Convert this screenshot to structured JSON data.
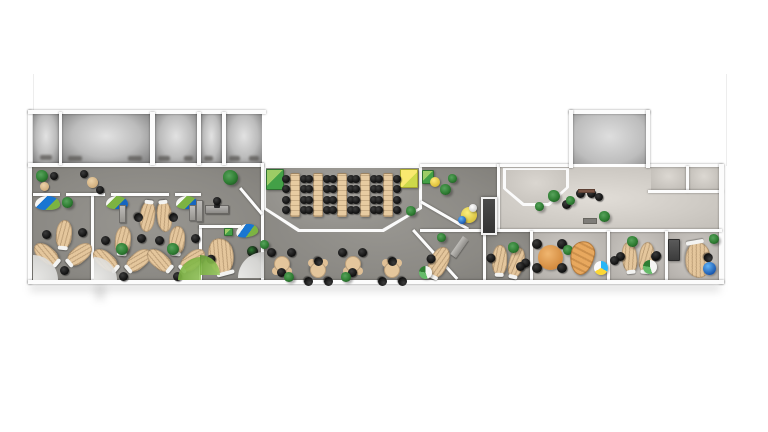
{
  "scene": {
    "name": "office-floor-plan",
    "style": "3d-top-down-architectural-render",
    "canvas": {
      "width": 768,
      "height": 432
    }
  },
  "palette": {
    "background": "#ffffff",
    "wall": "#fcfcfc",
    "floor_gray": "#8f8d89",
    "floor_beige": "#dcd8d2",
    "desk_wood": "#e4c69c",
    "chair_black": "#141414",
    "accent_green": "#7cb342",
    "accent_blue": "#1976d2",
    "accent_yellow": "#f4d94d",
    "plant_green": "#2e7d32",
    "elevator_dark": "#3d3d3d",
    "table_orange": "#e09a52"
  },
  "rooms": [
    {
      "name": "left-wing-floor",
      "x": 32,
      "y": 167,
      "w": 229,
      "h": 113,
      "floor": "gray"
    },
    {
      "name": "center-zone-floor",
      "x": 264,
      "y": 167,
      "w": 236,
      "h": 113,
      "floor": "gray"
    },
    {
      "name": "lobby-floor",
      "x": 500,
      "y": 167,
      "w": 219,
      "h": 63,
      "floor": "beige"
    },
    {
      "name": "office-right-1",
      "x": 486,
      "y": 232,
      "w": 44,
      "h": 48,
      "floor": "gray"
    },
    {
      "name": "office-right-2",
      "x": 533,
      "y": 232,
      "w": 74,
      "h": 48,
      "floor": "beige-gray"
    },
    {
      "name": "office-right-3",
      "x": 610,
      "y": 232,
      "w": 55,
      "h": 48,
      "floor": "beige-gray"
    },
    {
      "name": "office-right-4",
      "x": 668,
      "y": 232,
      "w": 51,
      "h": 48,
      "floor": "beige-gray"
    },
    {
      "name": "top-room-1",
      "x": 33,
      "y": 114,
      "w": 26,
      "h": 49,
      "floor": "cell"
    },
    {
      "name": "top-room-2",
      "x": 62,
      "y": 114,
      "w": 88,
      "h": 49,
      "floor": "cell"
    },
    {
      "name": "top-room-3",
      "x": 155,
      "y": 114,
      "w": 42,
      "h": 49,
      "floor": "cell"
    },
    {
      "name": "top-room-4",
      "x": 201,
      "y": 114,
      "w": 21,
      "h": 49,
      "floor": "cell"
    },
    {
      "name": "top-room-5",
      "x": 226,
      "y": 114,
      "w": 36,
      "h": 49,
      "floor": "cell"
    },
    {
      "name": "top-room-right",
      "x": 573,
      "y": 114,
      "w": 73,
      "h": 50,
      "floor": "cell-bright"
    },
    {
      "name": "top-small-room-1",
      "x": 651,
      "y": 167,
      "w": 35,
      "h": 23,
      "floor": "beige-light"
    },
    {
      "name": "top-small-room-2",
      "x": 689,
      "y": 167,
      "w": 30,
      "h": 23,
      "floor": "beige-light"
    },
    {
      "name": "training-room-walls",
      "x": 263,
      "y": 166,
      "w": 159,
      "h": 66,
      "floor": "wallfloor",
      "shape": "octagon"
    },
    {
      "name": "training-room-floor",
      "x": 266,
      "y": 168,
      "w": 153,
      "h": 61,
      "floor": "gray-light",
      "shape": "octagon"
    },
    {
      "name": "lobby-pod-walls",
      "x": 503,
      "y": 168,
      "w": 66,
      "h": 38,
      "floor": "wallfloor",
      "shape": "pod"
    },
    {
      "name": "lobby-pod-floor",
      "x": 506,
      "y": 170,
      "w": 60,
      "h": 33,
      "floor": "pod",
      "shape": "pod"
    }
  ],
  "walls": [
    {
      "x": 28,
      "y": 110,
      "w": 4,
      "h": 174
    },
    {
      "x": 28,
      "y": 110,
      "w": 238,
      "h": 4
    },
    {
      "x": 28,
      "y": 163,
      "w": 236,
      "h": 4
    },
    {
      "x": 59,
      "y": 112,
      "w": 3,
      "h": 53
    },
    {
      "x": 150,
      "y": 112,
      "w": 5,
      "h": 53
    },
    {
      "x": 197,
      "y": 112,
      "w": 4,
      "h": 53
    },
    {
      "x": 222,
      "y": 112,
      "w": 4,
      "h": 53
    },
    {
      "x": 261,
      "y": 163,
      "w": 3,
      "h": 119
    },
    {
      "x": 91,
      "y": 193,
      "w": 3,
      "h": 89
    },
    {
      "x": 33,
      "y": 193,
      "w": 27,
      "h": 3
    },
    {
      "x": 66,
      "y": 193,
      "w": 39,
      "h": 3
    },
    {
      "x": 111,
      "y": 193,
      "w": 58,
      "h": 3
    },
    {
      "x": 175,
      "y": 193,
      "w": 26,
      "h": 3
    },
    {
      "x": 199,
      "y": 225,
      "w": 3,
      "h": 57
    },
    {
      "x": 199,
      "y": 225,
      "w": 42,
      "h": 3
    },
    {
      "x": 239,
      "y": 189,
      "w": 3,
      "h": 34,
      "r": -40
    },
    {
      "x": 420,
      "y": 164,
      "w": 80,
      "h": 3
    },
    {
      "x": 420,
      "y": 203,
      "w": 3,
      "h": 55,
      "r": -60
    },
    {
      "x": 497,
      "y": 164,
      "w": 3,
      "h": 68
    },
    {
      "x": 500,
      "y": 164,
      "w": 72,
      "h": 3
    },
    {
      "x": 646,
      "y": 164,
      "w": 77,
      "h": 3
    },
    {
      "x": 569,
      "y": 110,
      "w": 81,
      "h": 4
    },
    {
      "x": 569,
      "y": 110,
      "w": 4,
      "h": 58
    },
    {
      "x": 646,
      "y": 110,
      "w": 4,
      "h": 58
    },
    {
      "x": 686,
      "y": 166,
      "w": 3,
      "h": 26
    },
    {
      "x": 648,
      "y": 190,
      "w": 75,
      "h": 3
    },
    {
      "x": 719,
      "y": 164,
      "w": 5,
      "h": 120
    },
    {
      "x": 420,
      "y": 229,
      "w": 302,
      "h": 3
    },
    {
      "x": 483,
      "y": 231,
      "w": 3,
      "h": 51
    },
    {
      "x": 530,
      "y": 231,
      "w": 3,
      "h": 51
    },
    {
      "x": 607,
      "y": 231,
      "w": 3,
      "h": 51
    },
    {
      "x": 665,
      "y": 231,
      "w": 3,
      "h": 51
    },
    {
      "x": 412,
      "y": 231,
      "w": 3,
      "h": 66,
      "r": -42
    },
    {
      "x": 28,
      "y": 280,
      "w": 696,
      "h": 4
    },
    {
      "x": 33,
      "y": 74,
      "w": 1,
      "h": 38,
      "v": "faint"
    },
    {
      "x": 726,
      "y": 74,
      "w": 1,
      "h": 92,
      "v": "faint"
    }
  ],
  "shadows": [
    {
      "x": 30,
      "y": 283,
      "w": 690,
      "h": 9
    },
    {
      "x": 95,
      "y": 284,
      "w": 10,
      "h": 16
    }
  ],
  "furniture": [
    {
      "t": "plant",
      "x": 36,
      "y": 170,
      "d": 12
    },
    {
      "t": "stool",
      "x": 40,
      "y": 182,
      "d": 9
    },
    {
      "t": "chair",
      "x": 50,
      "y": 172,
      "d": 8
    },
    {
      "t": "stool",
      "x": 87,
      "y": 177,
      "d": 11
    },
    {
      "t": "chair",
      "x": 80,
      "y": 170,
      "d": 8
    },
    {
      "t": "chair",
      "x": 96,
      "y": 186,
      "d": 8
    },
    {
      "t": "plant",
      "x": 223,
      "y": 170,
      "d": 15
    },
    {
      "t": "lounge",
      "x": 35,
      "y": 196,
      "w": 25,
      "h": 14,
      "v": "blue"
    },
    {
      "t": "plant",
      "x": 62,
      "y": 197,
      "d": 11
    },
    {
      "t": "trefoil",
      "x": 36,
      "y": 220
    },
    {
      "t": "rug",
      "x": 33,
      "y": 255,
      "d": 25,
      "v": "whiterug",
      "corner": "bl"
    },
    {
      "t": "lounge",
      "x": 106,
      "y": 196,
      "w": 22,
      "h": 13,
      "v": "green"
    },
    {
      "t": "lounge",
      "x": 176,
      "y": 196,
      "w": 22,
      "h": 13,
      "v": "green"
    },
    {
      "t": "sideboard",
      "x": 119,
      "y": 205,
      "w": 7,
      "h": 18
    },
    {
      "t": "sideboard",
      "x": 189,
      "y": 205,
      "w": 7,
      "h": 16
    },
    {
      "t": "deskpair",
      "x": 134,
      "y": 198,
      "r": 180
    },
    {
      "t": "trefoil",
      "x": 95,
      "y": 226
    },
    {
      "t": "trefoil",
      "x": 149,
      "y": 226
    },
    {
      "t": "plant",
      "x": 116,
      "y": 243,
      "d": 12
    },
    {
      "t": "plant",
      "x": 167,
      "y": 243,
      "d": 12
    },
    {
      "t": "rug",
      "x": 94,
      "y": 257,
      "d": 23,
      "v": "whiterug",
      "corner": "bl"
    },
    {
      "t": "rug",
      "x": 178,
      "y": 257,
      "d": 23,
      "v": "greenrug",
      "corner": "br"
    },
    {
      "t": "sideboard",
      "x": 196,
      "y": 200,
      "w": 7,
      "h": 22
    },
    {
      "t": "deskgray",
      "x": 205,
      "y": 205,
      "w": 24,
      "h": 9
    },
    {
      "t": "chair",
      "x": 213,
      "y": 197,
      "d": 8
    },
    {
      "t": "cabinet",
      "x": 224,
      "y": 228,
      "w": 9,
      "h": 8,
      "v": "green"
    },
    {
      "t": "lounge",
      "x": 236,
      "y": 224,
      "w": 22,
      "h": 13,
      "v": "blue",
      "r": -10
    },
    {
      "t": "deskC",
      "x": 206,
      "y": 236,
      "r": -15
    },
    {
      "t": "ball",
      "x": 247,
      "y": 246,
      "d": 11,
      "v": "darkgreen"
    },
    {
      "t": "rug",
      "x": 238,
      "y": 252,
      "d": 26,
      "v": "whiterug",
      "corner": "br"
    },
    {
      "t": "rug",
      "x": 200,
      "y": 255,
      "d": 20,
      "v": "greenrug",
      "corner": "bl"
    },
    {
      "t": "cabinet",
      "x": 266,
      "y": 169,
      "w": 18,
      "h": 21,
      "v": "green"
    },
    {
      "t": "cabinet",
      "x": 400,
      "y": 169,
      "w": 18,
      "h": 19,
      "v": "yellow"
    },
    {
      "t": "ttable",
      "x": 281,
      "y": 173
    },
    {
      "t": "ttable",
      "x": 304,
      "y": 173
    },
    {
      "t": "ttable",
      "x": 328,
      "y": 173
    },
    {
      "t": "ttable",
      "x": 351,
      "y": 173
    },
    {
      "t": "ttable",
      "x": 374,
      "y": 173
    },
    {
      "t": "plant",
      "x": 406,
      "y": 206,
      "d": 10
    },
    {
      "t": "cafe",
      "x": 267,
      "y": 248
    },
    {
      "t": "cafe",
      "x": 303,
      "y": 256,
      "r": 180
    },
    {
      "t": "cafe",
      "x": 338,
      "y": 248
    },
    {
      "t": "cafe",
      "x": 377,
      "y": 256,
      "r": 180
    },
    {
      "t": "plant",
      "x": 284,
      "y": 272,
      "d": 10
    },
    {
      "t": "plant",
      "x": 341,
      "y": 272,
      "d": 10
    },
    {
      "t": "plant",
      "x": 260,
      "y": 240,
      "d": 9
    },
    {
      "t": "cabinet",
      "x": 422,
      "y": 170,
      "w": 12,
      "h": 14,
      "v": "green"
    },
    {
      "t": "ball",
      "x": 430,
      "y": 177,
      "d": 10,
      "v": "yellow"
    },
    {
      "t": "plant",
      "x": 440,
      "y": 184,
      "d": 11
    },
    {
      "t": "plant",
      "x": 448,
      "y": 174,
      "d": 9
    },
    {
      "t": "rtable",
      "x": 461,
      "y": 207,
      "d": 16,
      "v": "yellowtable"
    },
    {
      "t": "ball",
      "x": 458,
      "y": 216,
      "d": 8,
      "v": "blue"
    },
    {
      "t": "ball",
      "x": 469,
      "y": 204,
      "d": 8,
      "v": "whiteball"
    },
    {
      "t": "elevator",
      "x": 481,
      "y": 197,
      "w": 16,
      "h": 38
    },
    {
      "t": "ramp",
      "x": 456,
      "y": 236,
      "w": 7,
      "h": 22,
      "r": 35
    },
    {
      "t": "desksingle",
      "x": 426,
      "y": 244,
      "r": 25
    },
    {
      "t": "ball",
      "x": 419,
      "y": 266,
      "d": 13,
      "v": "greenwhite"
    },
    {
      "t": "plant",
      "x": 437,
      "y": 233,
      "d": 9
    },
    {
      "t": "deskpair",
      "x": 486,
      "y": 244,
      "r": 8
    },
    {
      "t": "plant",
      "x": 508,
      "y": 242,
      "d": 11
    },
    {
      "t": "chair",
      "x": 516,
      "y": 262,
      "d": 9
    },
    {
      "t": "plant",
      "x": 548,
      "y": 190,
      "d": 12
    },
    {
      "t": "plant",
      "x": 535,
      "y": 202,
      "d": 9
    },
    {
      "t": "chair",
      "x": 576,
      "y": 189,
      "d": 9
    },
    {
      "t": "chair",
      "x": 587,
      "y": 189,
      "d": 9
    },
    {
      "t": "chair",
      "x": 562,
      "y": 200,
      "d": 9
    },
    {
      "t": "plant",
      "x": 566,
      "y": 196,
      "d": 9
    },
    {
      "t": "mat",
      "x": 583,
      "y": 218,
      "w": 14,
      "h": 6,
      "v": "graymat"
    },
    {
      "t": "mat",
      "x": 578,
      "y": 189,
      "w": 17,
      "h": 4,
      "v": "brownmat"
    },
    {
      "t": "plant",
      "x": 599,
      "y": 211,
      "d": 11
    },
    {
      "t": "chair",
      "x": 595,
      "y": 193,
      "d": 8
    },
    {
      "t": "rtable",
      "x": 538,
      "y": 245,
      "d": 25,
      "v": "orangetable"
    },
    {
      "t": "chair",
      "x": 532,
      "y": 239,
      "d": 10
    },
    {
      "t": "chair",
      "x": 557,
      "y": 239,
      "d": 10
    },
    {
      "t": "chair",
      "x": 532,
      "y": 263,
      "d": 10
    },
    {
      "t": "chair",
      "x": 557,
      "y": 263,
      "d": 10
    },
    {
      "t": "plant",
      "x": 563,
      "y": 245,
      "d": 10
    },
    {
      "t": "sofa",
      "x": 570,
      "y": 241,
      "w": 24,
      "h": 34,
      "r": 12
    },
    {
      "t": "ball",
      "x": 594,
      "y": 261,
      "d": 14,
      "v": "beach"
    },
    {
      "t": "deskpair",
      "x": 616,
      "y": 240
    },
    {
      "t": "plant",
      "x": 627,
      "y": 236,
      "d": 11
    },
    {
      "t": "chair",
      "x": 610,
      "y": 256,
      "d": 9
    },
    {
      "t": "chair",
      "x": 652,
      "y": 251,
      "d": 9
    },
    {
      "t": "ball",
      "x": 643,
      "y": 260,
      "d": 14,
      "v": "greenwhite"
    },
    {
      "t": "cabinet",
      "x": 668,
      "y": 239,
      "w": 12,
      "h": 22,
      "v": "dark"
    },
    {
      "t": "deskC",
      "x": 683,
      "y": 240,
      "r": 170
    },
    {
      "t": "ball",
      "x": 703,
      "y": 262,
      "d": 13,
      "v": "blue"
    },
    {
      "t": "plant",
      "x": 709,
      "y": 234,
      "d": 10
    },
    {
      "t": "mark",
      "x": 40,
      "y": 155,
      "w": 12,
      "h": 5
    },
    {
      "t": "mark",
      "x": 68,
      "y": 156,
      "w": 14,
      "h": 5
    },
    {
      "t": "mark",
      "x": 128,
      "y": 156,
      "w": 14,
      "h": 5
    },
    {
      "t": "mark",
      "x": 158,
      "y": 156,
      "w": 12,
      "h": 5
    },
    {
      "t": "mark",
      "x": 184,
      "y": 156,
      "w": 9,
      "h": 5
    },
    {
      "t": "mark",
      "x": 204,
      "y": 156,
      "w": 9,
      "h": 5
    },
    {
      "t": "mark",
      "x": 229,
      "y": 156,
      "w": 11,
      "h": 5
    },
    {
      "t": "mark",
      "x": 249,
      "y": 156,
      "w": 10,
      "h": 5
    }
  ]
}
